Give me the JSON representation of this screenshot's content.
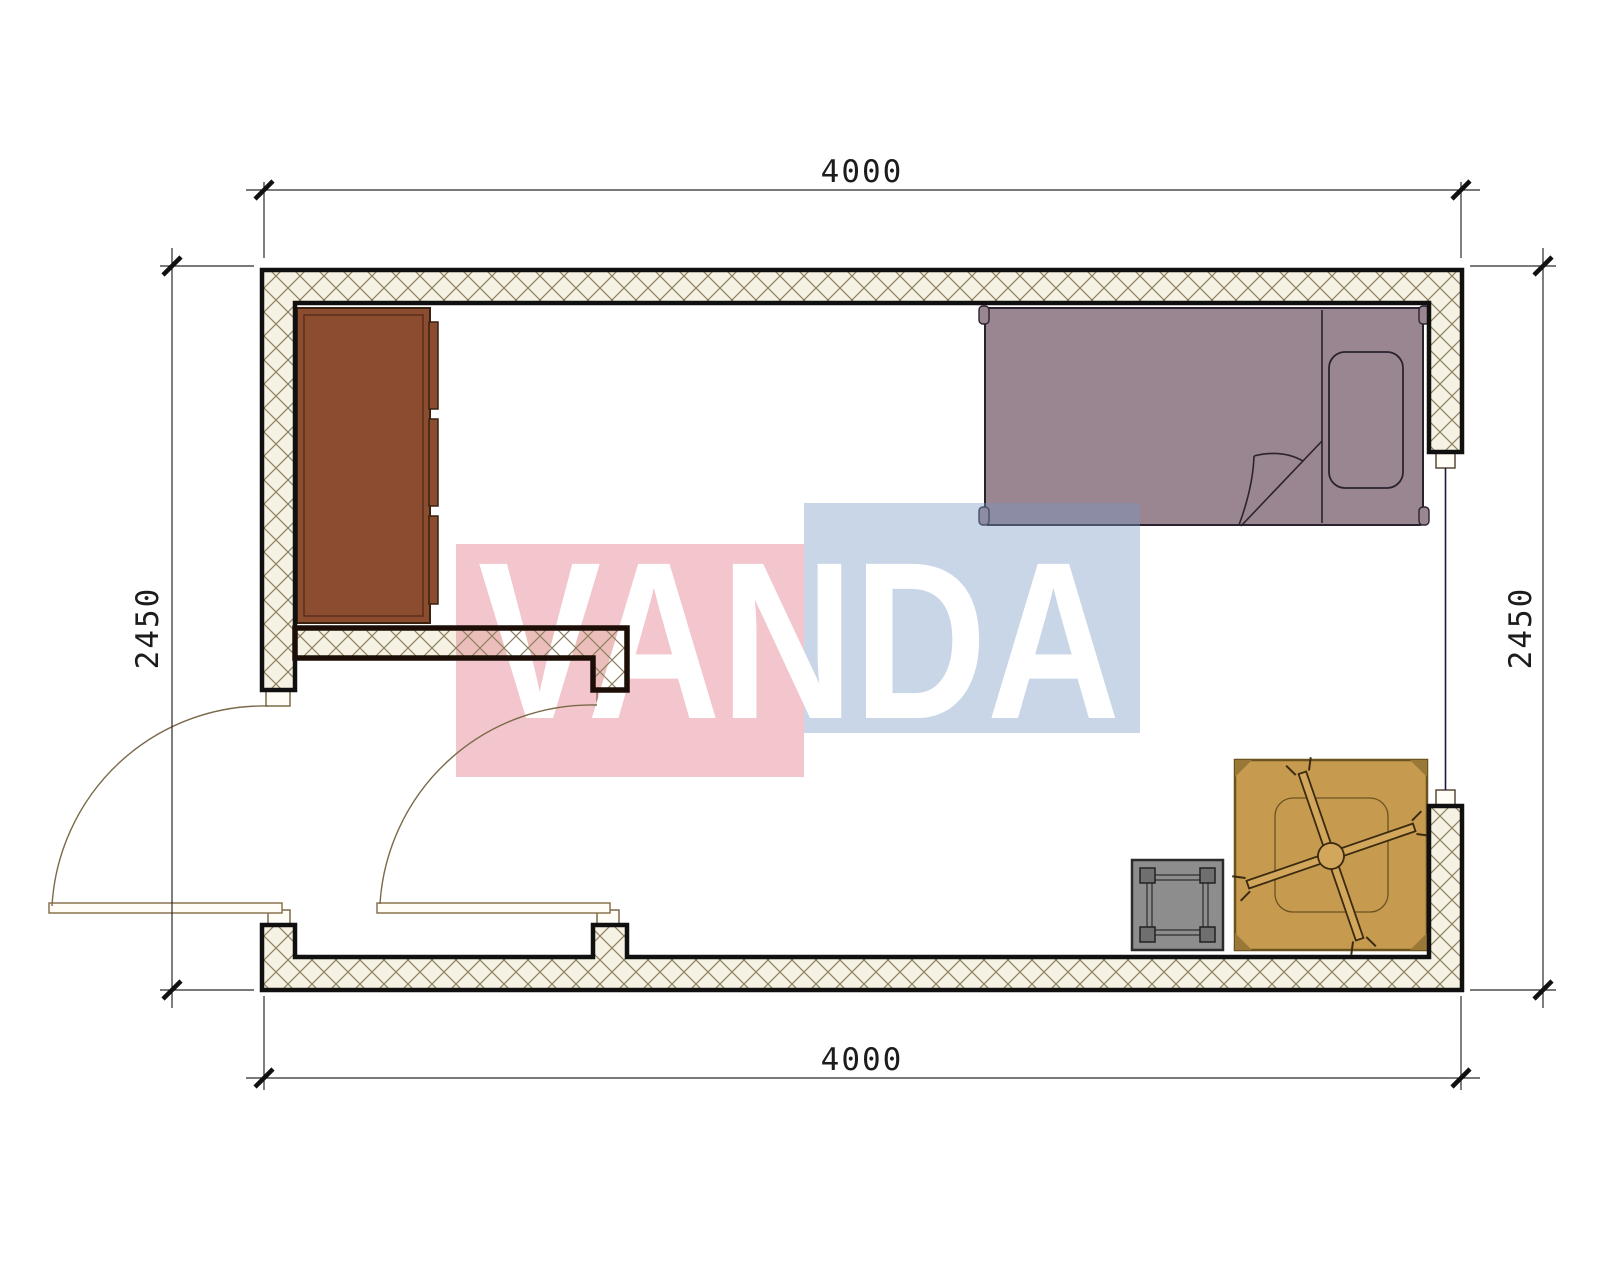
{
  "page": {
    "type": "architectural floor plan",
    "background": "#ffffff"
  },
  "dimensions": {
    "top": "4000",
    "bottom": "4000",
    "left": "2450",
    "right": "2450"
  },
  "watermark": {
    "text": "VANDA",
    "red_block": "#DE707F",
    "blue_block": "#7898C5",
    "text_color": "#FFFFFF",
    "block_opacity": "0.40"
  },
  "colors": {
    "wall_fill": "#F6F2E3",
    "hatch_line": "#8D8060",
    "wall_outline": "#101010",
    "partition_outline": "#1C0E06",
    "wardrobe": "#8B4C2F",
    "wardrobe_outline": "#38220F",
    "bed": "#9A8690",
    "bed_outline": "#2B2230",
    "table": "#C79B4F",
    "table_outline": "#3A2A10",
    "stool": "#8D8D8D",
    "stool_outline": "#2B2B2B",
    "door_line": "#7A6A4A",
    "jamb_fill": "#FFFDF5",
    "dimension_line": "#2A2A2A",
    "dimension_text": "#1C1C1C",
    "window_line": "#1A1A3A"
  },
  "furniture": [
    {
      "name": "wardrobe",
      "location": "top-left"
    },
    {
      "name": "single-bed",
      "location": "top-right",
      "parts": "pillow, folded blanket, bedposts"
    },
    {
      "name": "cross-leg-table",
      "location": "bottom-right"
    },
    {
      "name": "stool",
      "location": "bottom-right"
    }
  ],
  "openings": [
    {
      "name": "entry-door",
      "type": "swing-door",
      "wall": "left"
    },
    {
      "name": "interior-door",
      "type": "swing-door",
      "wall": "vestibule partition"
    },
    {
      "name": "window",
      "type": "window",
      "wall": "right"
    }
  ]
}
